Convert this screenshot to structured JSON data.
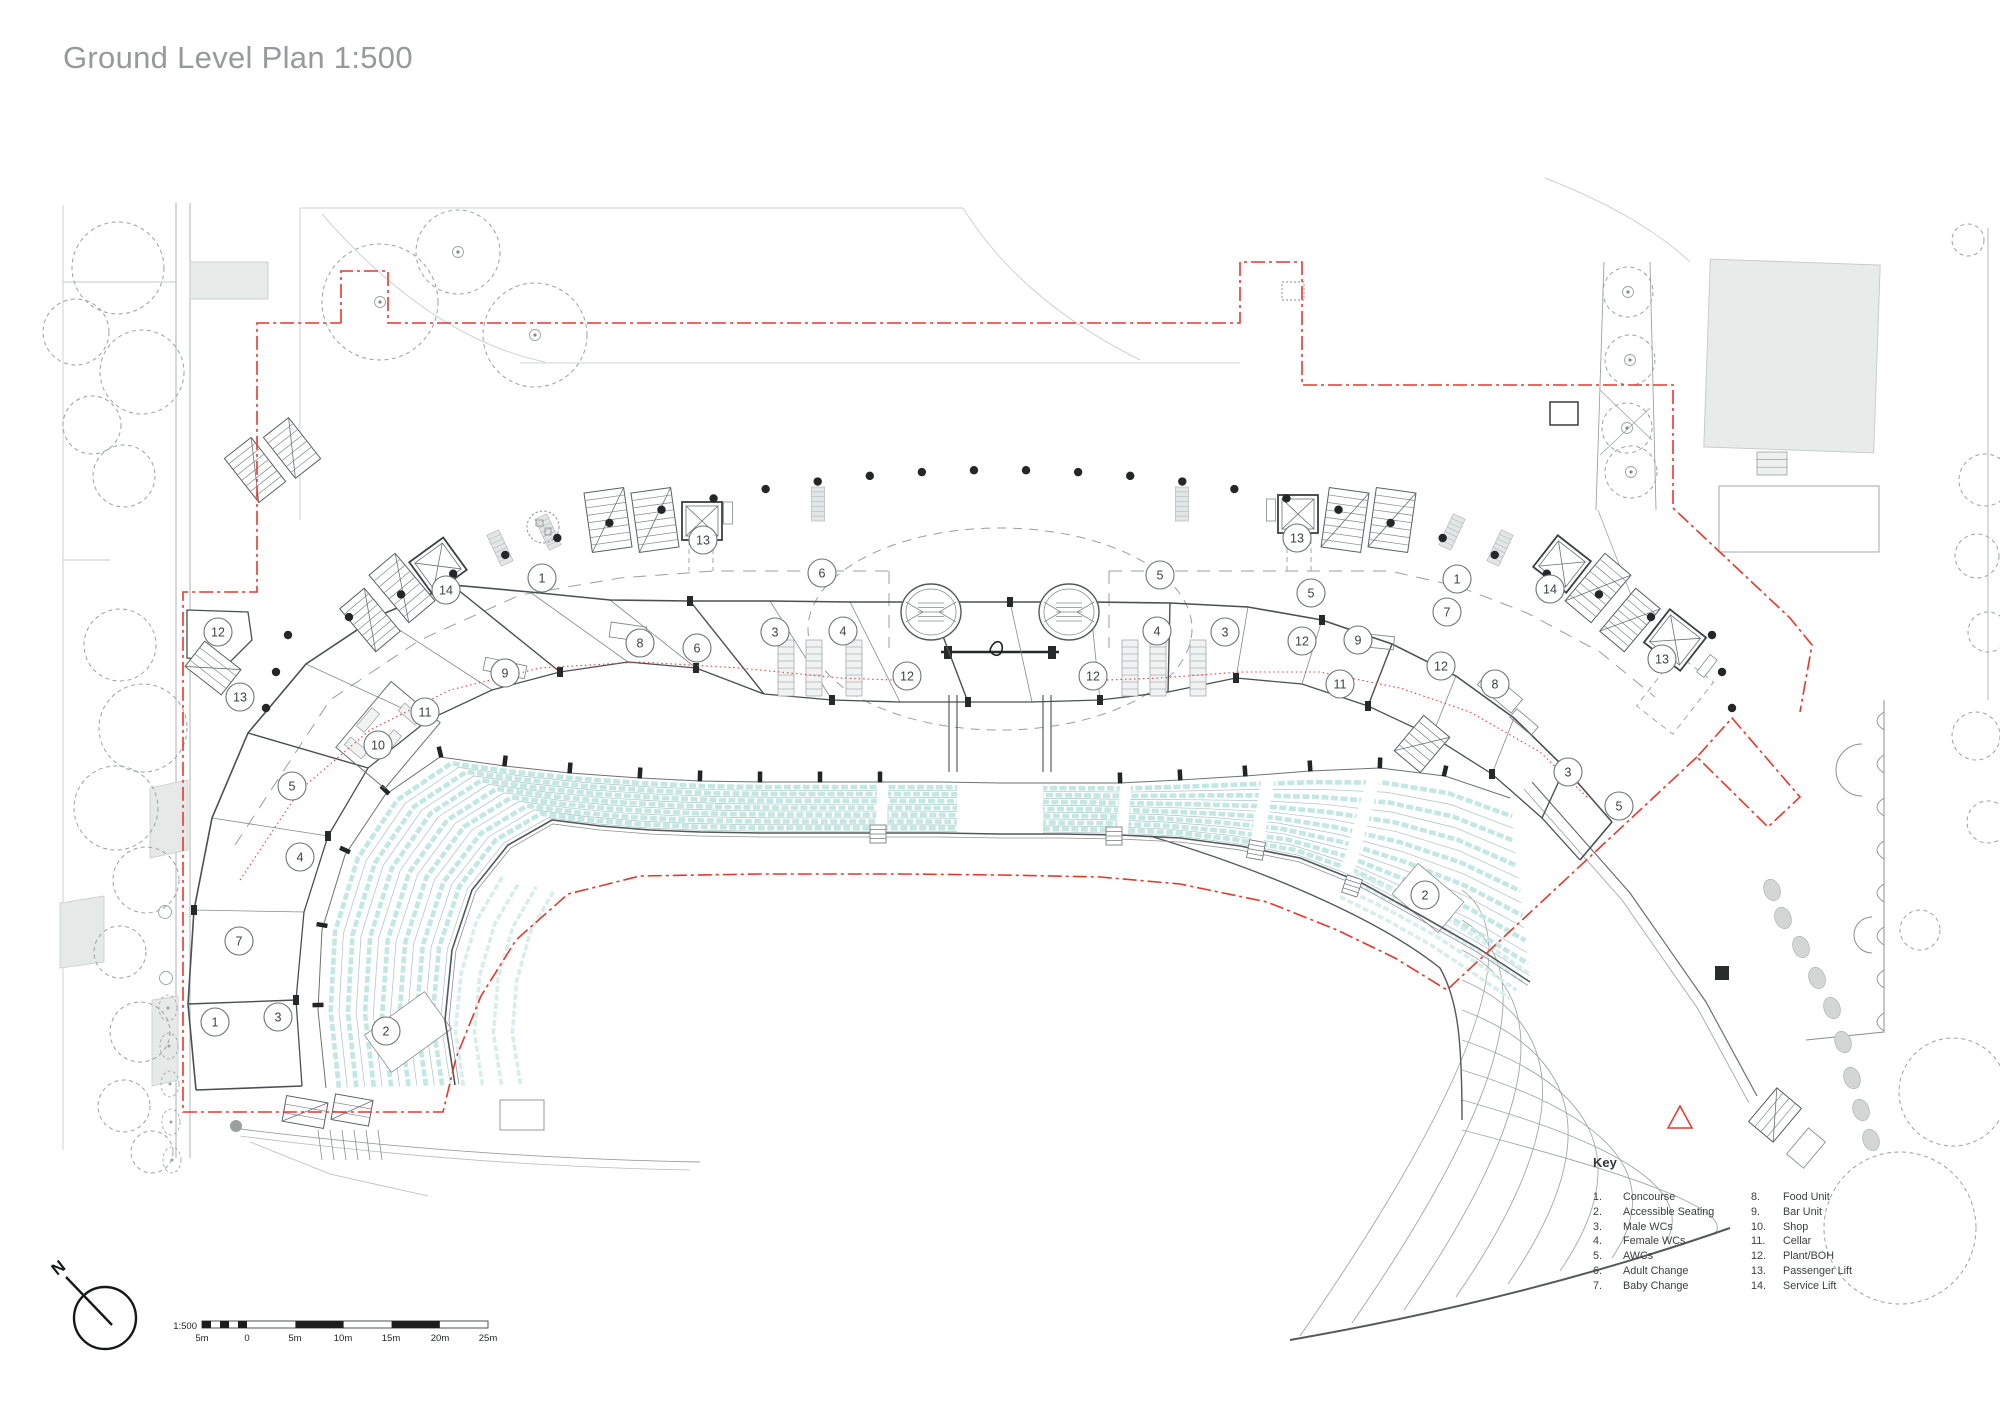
{
  "title": "Ground Level Plan 1:500",
  "key": {
    "heading": "Key",
    "items": [
      {
        "num": "1.",
        "label": "Concourse"
      },
      {
        "num": "2.",
        "label": "Accessible Seating"
      },
      {
        "num": "3.",
        "label": "Male WCs"
      },
      {
        "num": "4.",
        "label": "Female WCs"
      },
      {
        "num": "5.",
        "label": "AWCs"
      },
      {
        "num": "6.",
        "label": "Adult Change"
      },
      {
        "num": "7.",
        "label": "Baby Change"
      },
      {
        "num": "8.",
        "label": "Food Unit"
      },
      {
        "num": "9.",
        "label": "Bar Unit"
      },
      {
        "num": "10.",
        "label": "Shop"
      },
      {
        "num": "11.",
        "label": "Cellar"
      },
      {
        "num": "12.",
        "label": "Plant/BOH"
      },
      {
        "num": "13.",
        "label": "Passenger Lift"
      },
      {
        "num": "14.",
        "label": "Service Lift"
      }
    ]
  },
  "scale_bar": {
    "ratio": "1:500",
    "tick_labels": [
      "5m",
      "0",
      "5m",
      "10m",
      "15m",
      "20m",
      "25m"
    ]
  },
  "north_label": "N",
  "plan_markers": [
    {
      "n": "12",
      "x": 218,
      "y": 632
    },
    {
      "n": "13",
      "x": 240,
      "y": 697
    },
    {
      "n": "5",
      "x": 292,
      "y": 786
    },
    {
      "n": "4",
      "x": 300,
      "y": 857
    },
    {
      "n": "7",
      "x": 239,
      "y": 941
    },
    {
      "n": "1",
      "x": 215,
      "y": 1022
    },
    {
      "n": "3",
      "x": 278,
      "y": 1017
    },
    {
      "n": "2",
      "x": 386,
      "y": 1031
    },
    {
      "n": "10",
      "x": 378,
      "y": 745
    },
    {
      "n": "11",
      "x": 425,
      "y": 712
    },
    {
      "n": "9",
      "x": 505,
      "y": 673
    },
    {
      "n": "8",
      "x": 640,
      "y": 643
    },
    {
      "n": "6",
      "x": 697,
      "y": 648
    },
    {
      "n": "3",
      "x": 775,
      "y": 632
    },
    {
      "n": "4",
      "x": 843,
      "y": 631
    },
    {
      "n": "12",
      "x": 907,
      "y": 676
    },
    {
      "n": "6",
      "x": 822,
      "y": 573
    },
    {
      "n": "13",
      "x": 703,
      "y": 540
    },
    {
      "n": "14",
      "x": 446,
      "y": 590
    },
    {
      "n": "1",
      "x": 542,
      "y": 578
    },
    {
      "n": "12",
      "x": 1093,
      "y": 676
    },
    {
      "n": "4",
      "x": 1157,
      "y": 631
    },
    {
      "n": "3",
      "x": 1225,
      "y": 632
    },
    {
      "n": "5",
      "x": 1160,
      "y": 575
    },
    {
      "n": "12",
      "x": 1302,
      "y": 641
    },
    {
      "n": "5",
      "x": 1311,
      "y": 593
    },
    {
      "n": "9",
      "x": 1358,
      "y": 640
    },
    {
      "n": "11",
      "x": 1340,
      "y": 684
    },
    {
      "n": "13",
      "x": 1297,
      "y": 538
    },
    {
      "n": "1",
      "x": 1457,
      "y": 579
    },
    {
      "n": "14",
      "x": 1550,
      "y": 589
    },
    {
      "n": "7",
      "x": 1447,
      "y": 612
    },
    {
      "n": "12",
      "x": 1441,
      "y": 666
    },
    {
      "n": "8",
      "x": 1495,
      "y": 684
    },
    {
      "n": "13",
      "x": 1662,
      "y": 659
    },
    {
      "n": "3",
      "x": 1568,
      "y": 772
    },
    {
      "n": "5",
      "x": 1619,
      "y": 806
    },
    {
      "n": "2",
      "x": 1425,
      "y": 895
    }
  ],
  "colors": {
    "accent_red": "#e2392e",
    "seating_teal": "#c3e7e3",
    "line_gray": "#75797c",
    "title_gray": "#97999b"
  }
}
